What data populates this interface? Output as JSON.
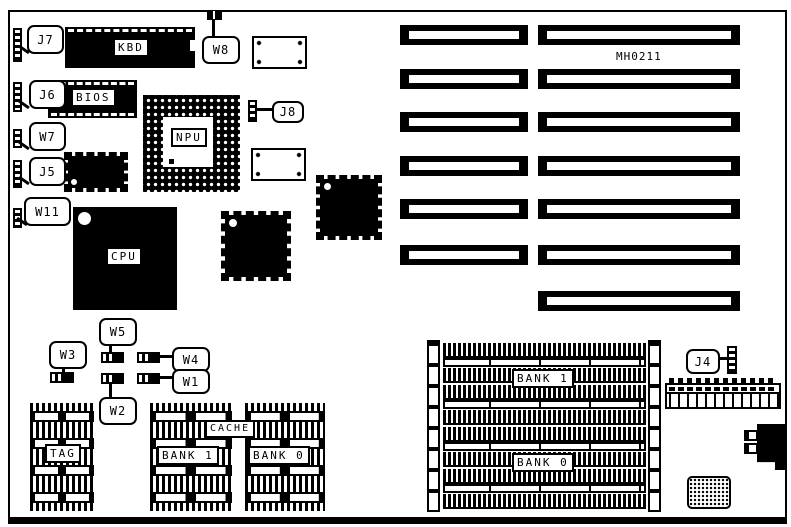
{
  "board": {
    "model_label": "MH0211",
    "chips": {
      "kbd": "KBD",
      "bios": "BIOS",
      "npu": "NPU",
      "cpu": "CPU"
    },
    "cache": {
      "tag_label": "TAG",
      "cache_label": "CACHE",
      "bank1_label": "BANK 1",
      "bank0_label": "BANK 0"
    },
    "memory": {
      "bank1_label": "BANK 1",
      "bank0_label": "BANK 0"
    },
    "callouts": {
      "j7": "J7",
      "j6": "J6",
      "j5": "J5",
      "j8": "J8",
      "j4": "J4",
      "w1": "W1",
      "w2": "W2",
      "w3": "W3",
      "w4": "W4",
      "w5": "W5",
      "w7": "W7",
      "w8": "W8",
      "w11": "W11"
    }
  }
}
